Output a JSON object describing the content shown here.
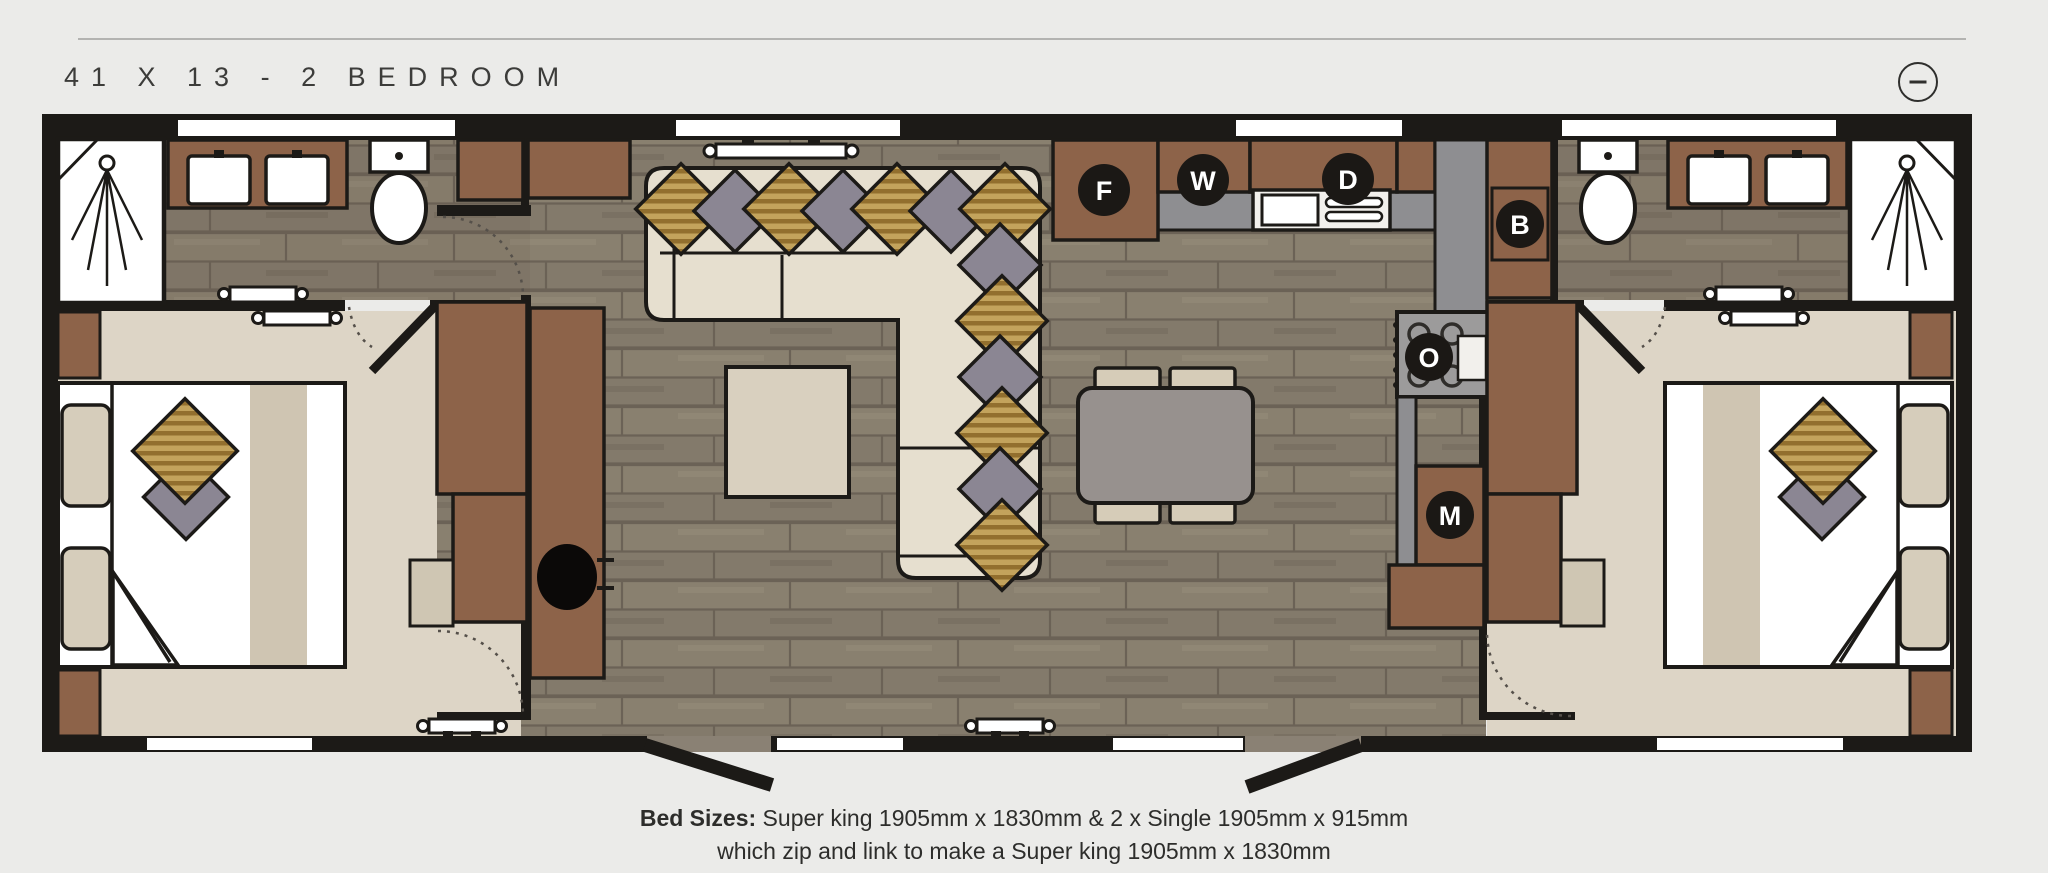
{
  "header": {
    "title": "41 X 13 - 2 BEDROOM",
    "collapse_icon": "minus-circle"
  },
  "floorplan": {
    "appliance_badges": [
      {
        "code": "F"
      },
      {
        "code": "W"
      },
      {
        "code": "D"
      },
      {
        "code": "B"
      },
      {
        "code": "O"
      },
      {
        "code": "M"
      }
    ],
    "colors": {
      "wall": "#1c1a17",
      "wood_floor": "#877d6f",
      "carpet": "#ddd5c6",
      "cabinet_brown": "#8d6349",
      "sofa_cream": "#e6dfcf",
      "pillow_gold": "#bd9c55",
      "pillow_grey": "#8b8693",
      "counter_grey": "#8e8e91",
      "badge_black": "#1b1815"
    }
  },
  "caption": {
    "bold_label": "Bed Sizes:",
    "line1_rest": " Super king 1905mm x 1830mm & 2 x Single 1905mm x 915mm",
    "line2": "which zip and link to make a Super king 1905mm x 1830mm"
  }
}
